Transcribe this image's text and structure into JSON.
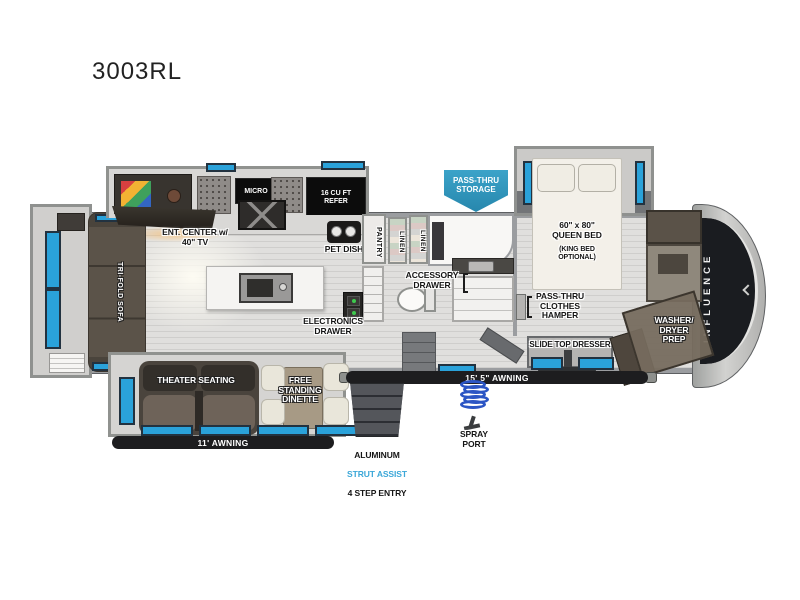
{
  "title": "3003RL",
  "front_cap": {
    "brand": "INFLUENCE"
  },
  "banner": {
    "pass_thru_storage": "PASS-THRU\nSTORAGE"
  },
  "kitchen": {
    "micro": "MICRO",
    "refer": "16 CU FT\nREFER",
    "ent_center": "ENT. CENTER w/\n40\" TV",
    "pet_dish": "PET DISH",
    "pantry": "PANTRY"
  },
  "bath": {
    "linen_a": "LINEN",
    "linen_b": "LINEN",
    "accessory_drawer": "ACCESSORY\nDRAWER"
  },
  "living": {
    "tri_fold_sofa": "TRI-FOLD SOFA",
    "theater_seating": "THEATER SEATING",
    "dinette": "FREE\nSTANDING\nDINETTE",
    "electronics_drawer": "ELECTRONICS\nDRAWER"
  },
  "bedroom": {
    "queen_bed": "60\" x 80\"\nQUEEN BED",
    "king_option": "(KING BED\nOPTIONAL)",
    "hamper": "PASS-THRU\nCLOTHES\nHAMPER",
    "dresser": "SLIDE TOP DRESSER",
    "washer_dryer": "WASHER/\nDRYER\nPREP"
  },
  "exterior": {
    "awning_rear": "11' AWNING",
    "awning_main": "15' 5\" AWNING",
    "entry_line1": "ALUMINUM",
    "entry_line2": "STRUT ASSIST",
    "entry_line3": "4 STEP ENTRY",
    "spray_port": "SPRAY\nPORT"
  },
  "colors": {
    "window_blue": "#2aa2da",
    "banner_blue": "#2d93ba",
    "strut_blue": "#3ba7d8",
    "cap_black": "#1a1c20"
  }
}
